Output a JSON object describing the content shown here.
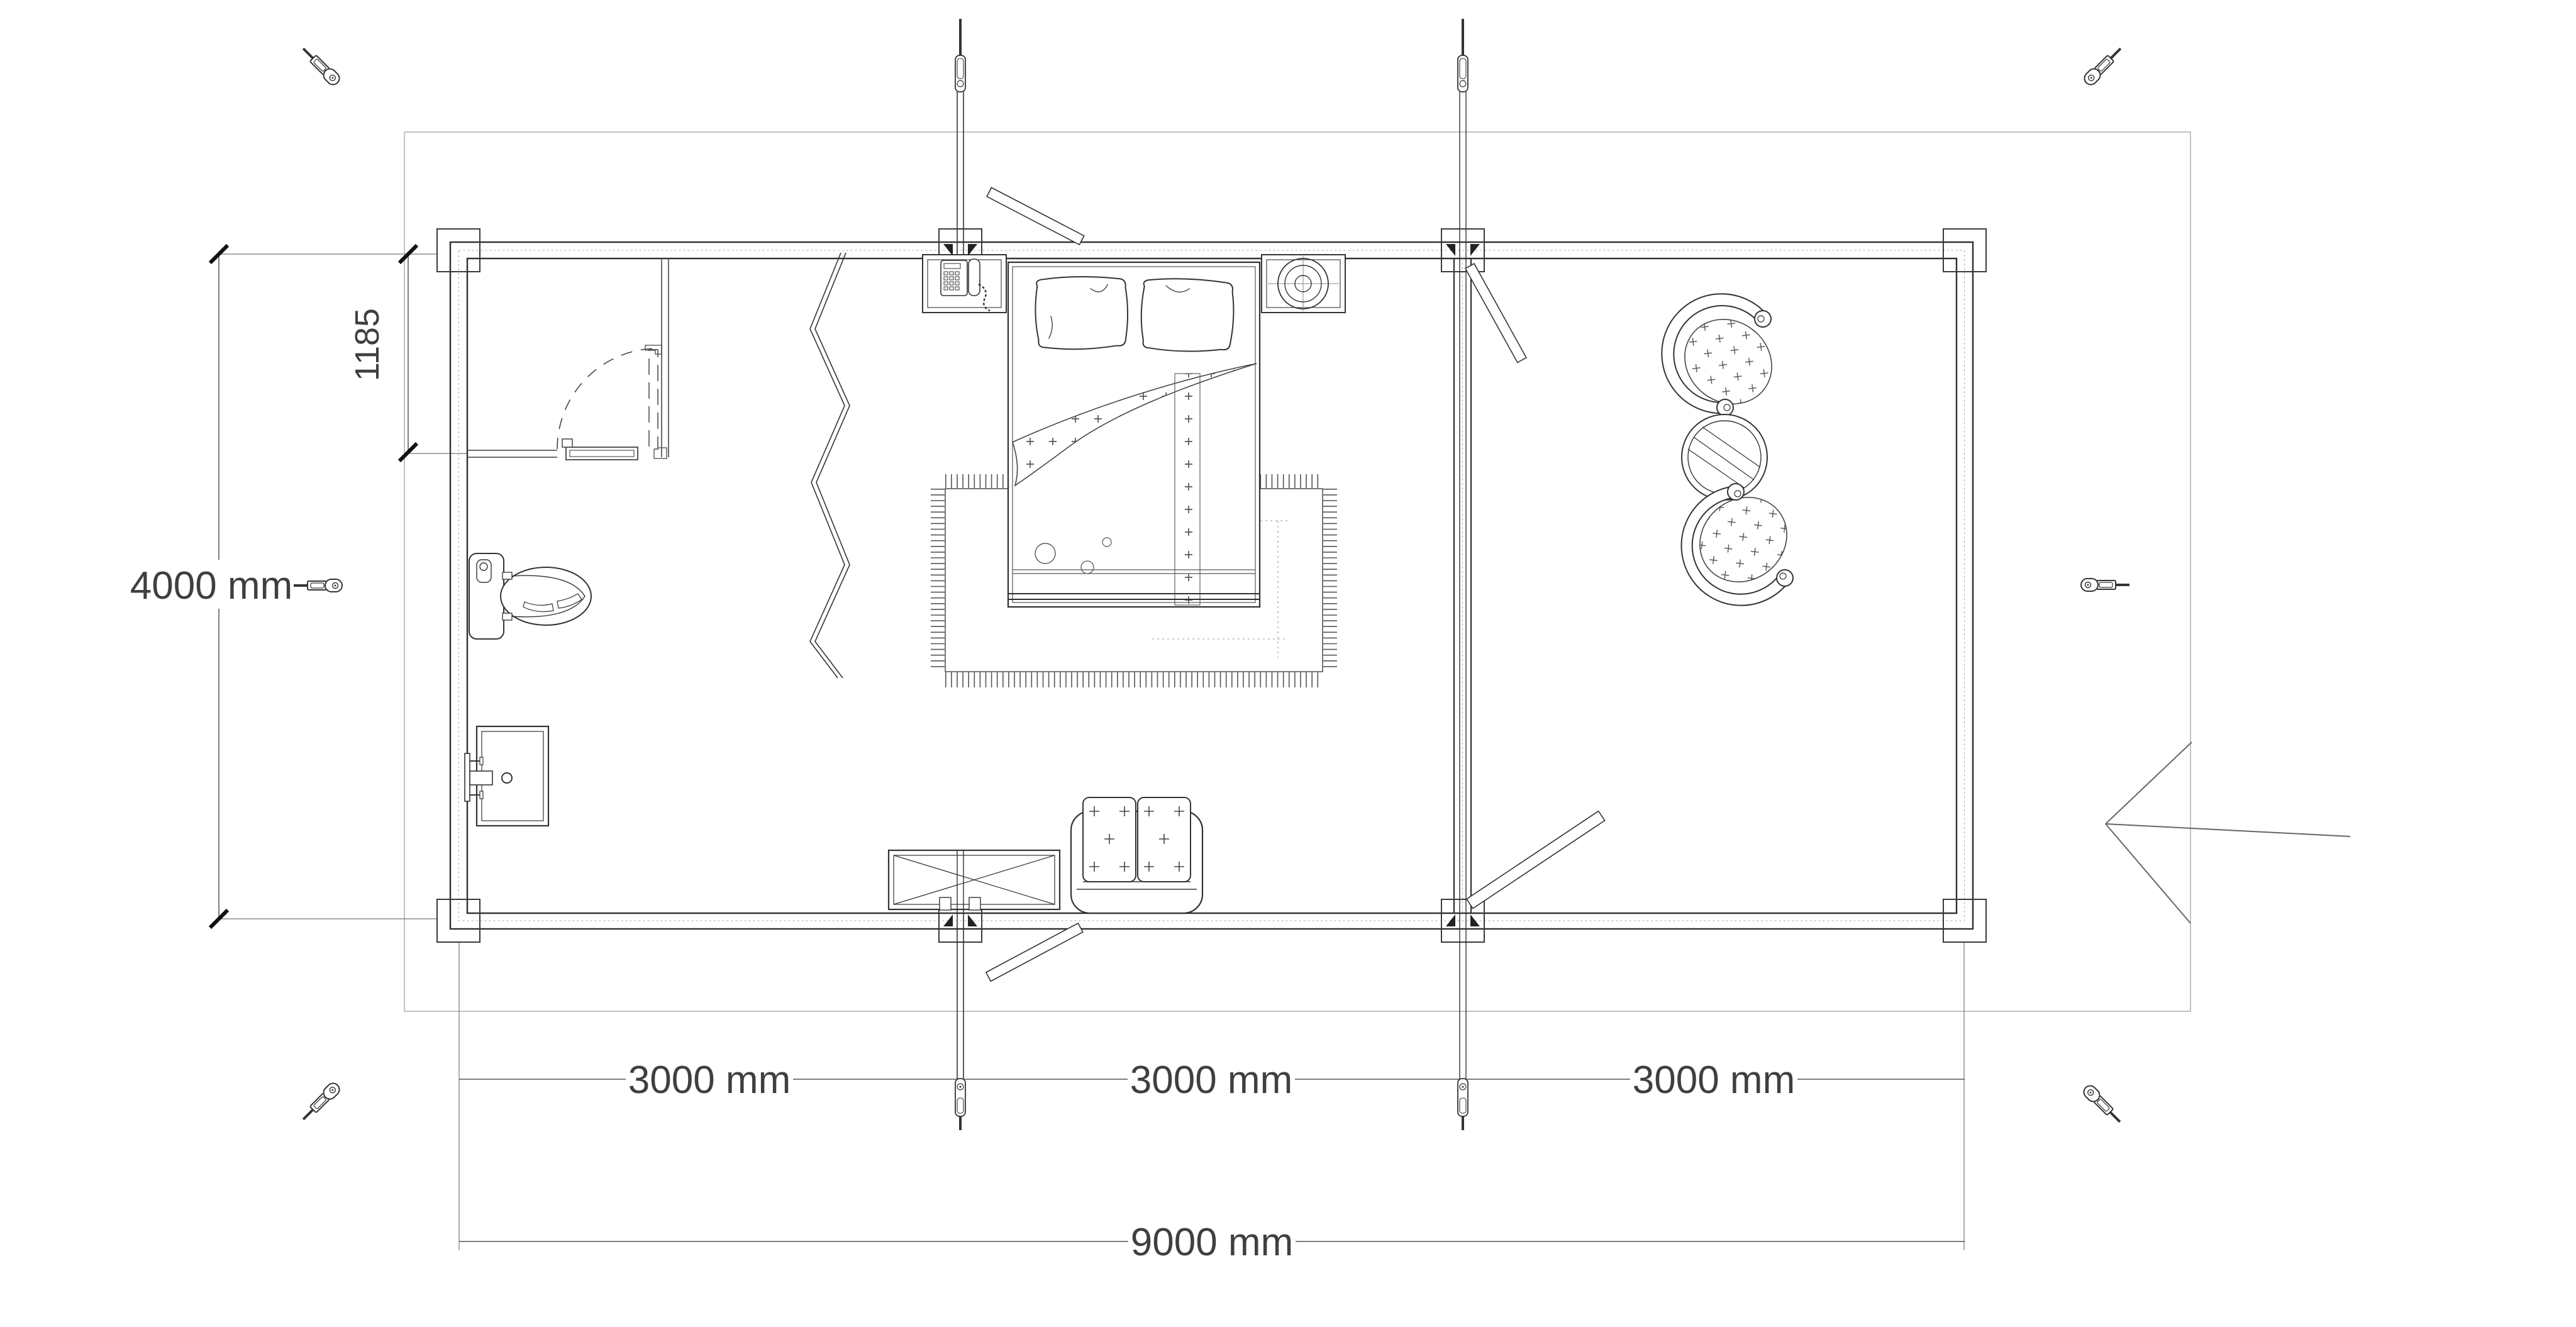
{
  "drawing": {
    "dimensions": {
      "height_label": "4000 mm",
      "bath_offset_label": "1185",
      "bay_labels": [
        "3000 mm",
        "3000 mm",
        "3000 mm"
      ],
      "total_width_label": "9000 mm",
      "height_mm": 4000,
      "bath_offset_mm": 1185,
      "bay_mm": 3000,
      "total_width_mm": 9000
    },
    "colors": {
      "background": "#ffffff",
      "ink": "#2f2f2f",
      "medium": "#666666",
      "light": "#999999",
      "border": "#b3b3b3",
      "text": "#3f3f3f"
    },
    "icons": {
      "tie_down_anchor": "turnbuckle-anchor-icon",
      "storm_rod": "storm-tie-rod-icon",
      "entry": "entry-arrow-icon"
    }
  }
}
